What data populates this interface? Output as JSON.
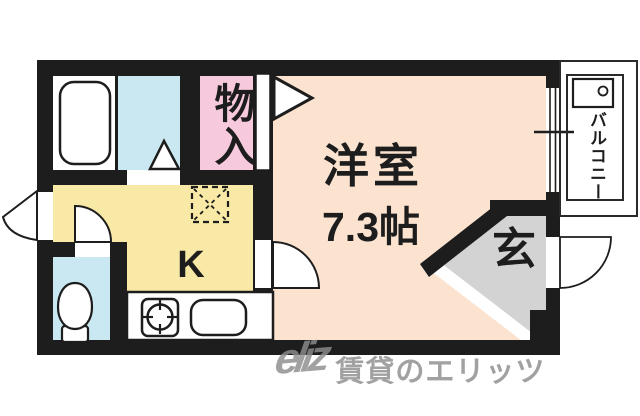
{
  "plan": {
    "type": "apartment-floorplan",
    "rooms": {
      "western_room": {
        "label": "洋室",
        "size": "7.3帖"
      },
      "kitchen": {
        "label": "K"
      },
      "closet": {
        "label": "物入"
      },
      "entrance": {
        "label": "玄"
      },
      "balcony": {
        "label": "バルコニー"
      }
    },
    "fixtures": [
      "bathtub-icon",
      "toilet-icon",
      "gas-stove-icon",
      "sink-icon",
      "washing-machine-icon",
      "refrigerator-space-icon",
      "door-swing-icon",
      "folding-door-triangle-icon",
      "window-symbol"
    ],
    "colors": {
      "wall": "#1d1d1d",
      "western_room": "#fbe3d0",
      "kitchen": "#f8e9a6",
      "closet": "#f7c9dc",
      "water_area": "#c9e8f1",
      "entrance_floor": "#d3d3d3",
      "fixture_white": "#ffffff"
    },
    "watermark": {
      "logo": "eliz",
      "brand": "賃貸のエリッツ"
    }
  }
}
